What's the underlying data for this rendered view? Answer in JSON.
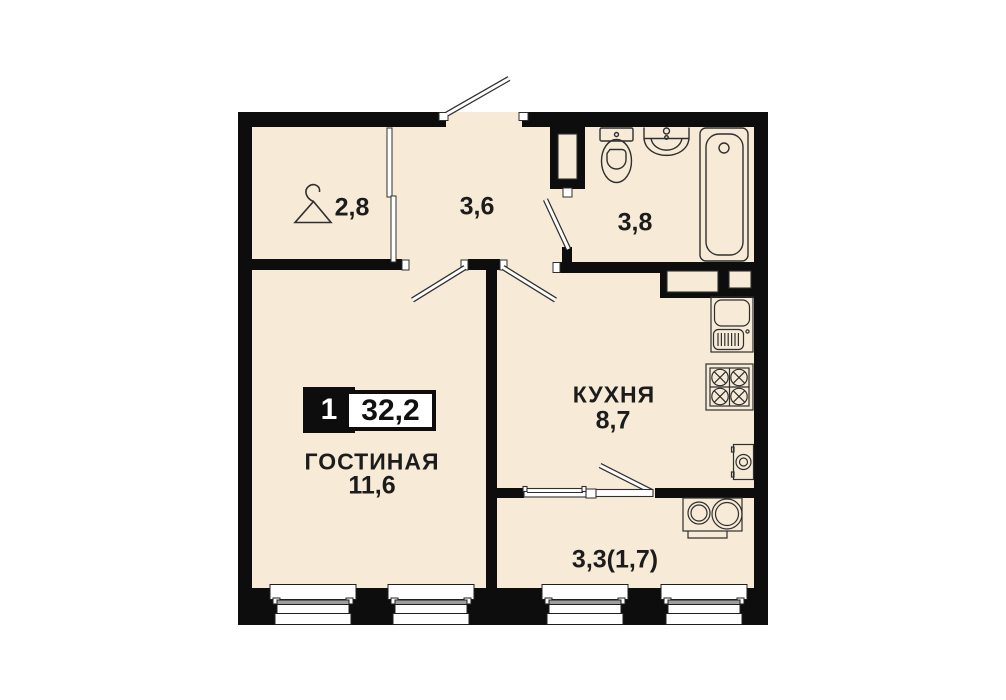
{
  "plan_badge": {
    "room_count": "1",
    "total_area": "32,2"
  },
  "rooms": [
    {
      "key": "wardrobe",
      "area": "2,8"
    },
    {
      "key": "hallway",
      "area": "3,6"
    },
    {
      "key": "bathroom",
      "area": "3,8"
    },
    {
      "key": "kitchen",
      "name": "КУХНЯ",
      "area": "8,7"
    },
    {
      "key": "living_room",
      "name": "ГОСТИНАЯ",
      "area": "11,6"
    },
    {
      "key": "balcony",
      "area": "3,3(1,7)"
    }
  ],
  "fixtures": [
    "hanger-icon",
    "entrance-door-icon",
    "toilet-icon",
    "washbasin-icon",
    "bathtub-icon",
    "kitchen-sink-icon",
    "stove-icon",
    "washing-machine-icon",
    "balcony-sink-icon",
    "window-icon"
  ],
  "colors": {
    "floor": "#f7ebd8",
    "wall": "#0d0d0d",
    "fixture_line": "#2f2f2f",
    "window_gray": "#9e9e9e"
  }
}
